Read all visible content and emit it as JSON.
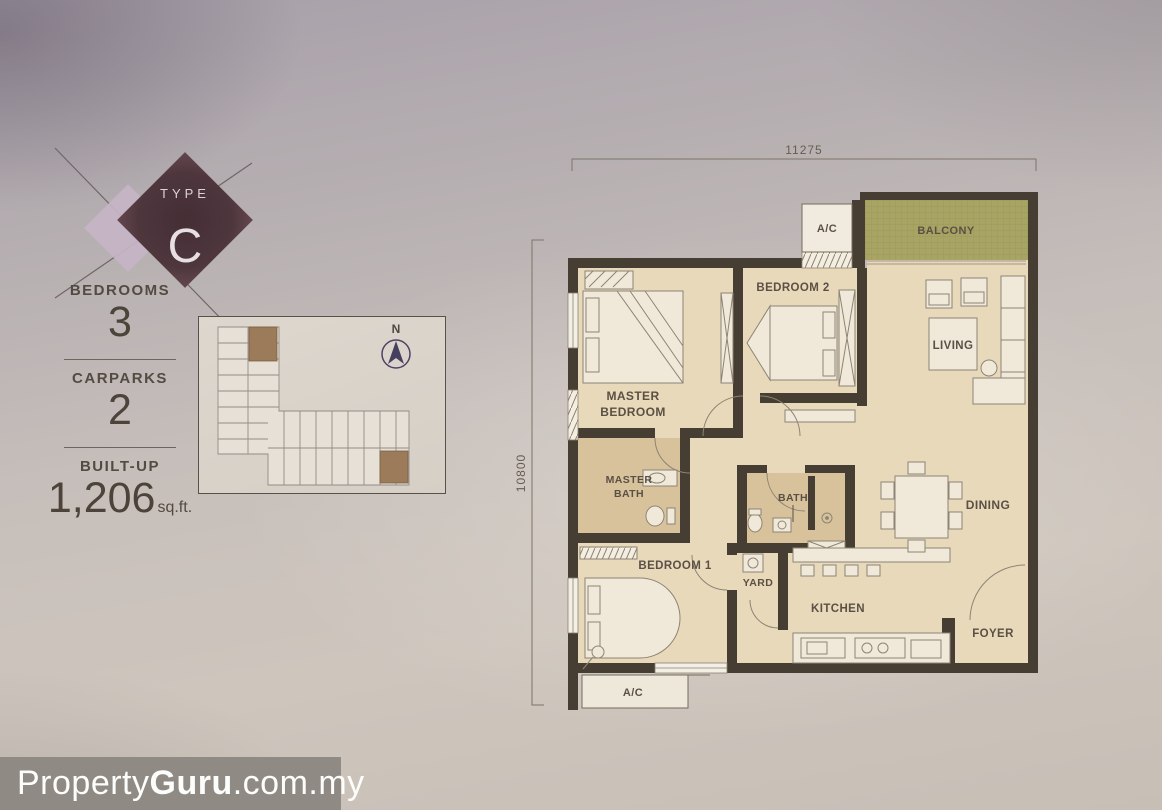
{
  "badge": {
    "type_label": "TYPE",
    "type_value": "C"
  },
  "specs": [
    {
      "label": "BEDROOMS",
      "value": "3"
    },
    {
      "label": "CARPARKS",
      "value": "2"
    },
    {
      "label": "BUILT-UP",
      "value": "1,206",
      "unit": "sq.ft."
    }
  ],
  "key_plan": {
    "compass_label": "N"
  },
  "floor_plan": {
    "dimension_top": "11275",
    "dimension_left": "10800",
    "rooms": {
      "balcony": "BALCONY",
      "ac_top": "A/C",
      "ac_bottom": "A/C",
      "bedroom2": "BEDROOM 2",
      "master_bedroom_line1": "MASTER",
      "master_bedroom_line2": "BEDROOM",
      "living": "LIVING",
      "master_bath_line1": "MASTER",
      "master_bath_line2": "BATH",
      "bath": "BATH",
      "bedroom1": "BEDROOM 1",
      "yard": "YARD",
      "kitchen": "KITCHEN",
      "dining": "DINING",
      "foyer": "FOYER"
    }
  },
  "watermark": {
    "brand_regular": "Property",
    "brand_bold": "Guru",
    "domain_suffix": ".com.my"
  },
  "colors": {
    "badge_dark": "#4d363d",
    "badge_light": "#c7b6c7",
    "balcony": "#a8a464",
    "room_fill": "#e9d9bb",
    "bath_fill": "#d8c29b",
    "wall": "#463e33",
    "watermark_bar": "#8f8b84"
  }
}
